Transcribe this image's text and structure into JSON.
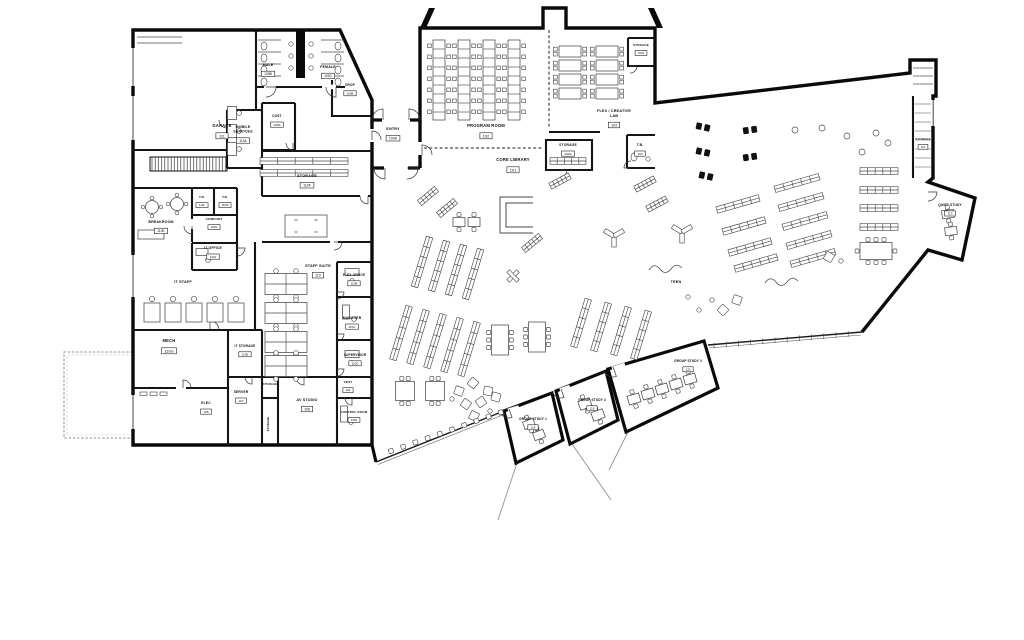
{
  "plan": {
    "type": "architectural-floor-plan",
    "building": "Public Library — Furniture Floor Plan",
    "colors": {
      "wall": "#0a0a0a",
      "interior_wall": "#151515",
      "furniture": "#4a4a4a",
      "glass": "#1a1a1a",
      "site": "#909090",
      "background": "#ffffff",
      "label": "#101010"
    },
    "rooms": [
      {
        "name": "garage",
        "lines": [
          "GARAGE"
        ],
        "number": "111",
        "x": 222,
        "y": 127
      },
      {
        "name": "male",
        "lines": [
          "MALE"
        ],
        "number": "105B",
        "x": 268,
        "y": 66,
        "size": 3.6
      },
      {
        "name": "female",
        "lines": [
          "FEMALE"
        ],
        "number": "105C",
        "x": 328,
        "y": 68,
        "size": 3.6
      },
      {
        "name": "drop",
        "lines": [
          "DROP"
        ],
        "number": "100B",
        "x": 350,
        "y": 86,
        "size": 3.2
      },
      {
        "name": "cust",
        "lines": [
          "CUST"
        ],
        "number": "105A",
        "x": 277,
        "y": 117,
        "size": 3.4
      },
      {
        "name": "mobile-services",
        "lines": [
          "MOBILE",
          "SERVICES"
        ],
        "number": "110A",
        "x": 243,
        "y": 128,
        "size": 3.6
      },
      {
        "name": "entry",
        "lines": [
          "ENTRY"
        ],
        "number": "100A",
        "x": 393,
        "y": 130,
        "size": 3.8
      },
      {
        "name": "storage-110f",
        "lines": [
          "STORAGE"
        ],
        "number": "110F",
        "x": 307,
        "y": 177,
        "size": 3.8
      },
      {
        "name": "program-room",
        "lines": [
          "PROGRAM ROOM"
        ],
        "number": "102",
        "x": 486,
        "y": 127
      },
      {
        "name": "flex-creative-lab",
        "lines": [
          "FLEX / CREATIVE",
          "LAB"
        ],
        "number": "103",
        "x": 614,
        "y": 112,
        "size": 3.8
      },
      {
        "name": "storage-103a",
        "lines": [
          "STORAGE"
        ],
        "number": "103A",
        "x": 641,
        "y": 46,
        "size": 3
      },
      {
        "name": "tb-104",
        "lines": [
          "T.B."
        ],
        "number": "104",
        "x": 640,
        "y": 146,
        "size": 3.4
      },
      {
        "name": "storage-102a",
        "lines": [
          "STORAGE"
        ],
        "number": "102A",
        "x": 568,
        "y": 146,
        "size": 3.4
      },
      {
        "name": "core-library",
        "lines": [
          "CORE LIBRARY"
        ],
        "number": "101",
        "x": 513,
        "y": 161
      },
      {
        "name": "breakroom",
        "lines": [
          "BREAKROOM"
        ],
        "number": "110K",
        "x": 161,
        "y": 223,
        "size": 3.6
      },
      {
        "name": "tb-110l",
        "lines": [
          "T.B."
        ],
        "number": "110L",
        "x": 202,
        "y": 198,
        "size": 3.1
      },
      {
        "name": "tb-110m",
        "lines": [
          "T.B."
        ],
        "number": "110M",
        "x": 225,
        "y": 198,
        "size": 3.1
      },
      {
        "name": "comfort",
        "lines": [
          "COMFORT"
        ],
        "number": "110N",
        "x": 214,
        "y": 220,
        "size": 3.1
      },
      {
        "name": "it-office",
        "lines": [
          "IT OFFICE"
        ],
        "number": "110J",
        "x": 213,
        "y": 249,
        "size": 3.4
      },
      {
        "name": "it-staff",
        "lines": [
          "IT STAFF"
        ],
        "number": "",
        "x": 183,
        "y": 283,
        "size": 3.8
      },
      {
        "name": "staff-suite",
        "lines": [
          "STAFF SUITE"
        ],
        "number": "110",
        "x": 318,
        "y": 267,
        "size": 3.8
      },
      {
        "name": "flex-office",
        "lines": [
          "FLEX OFFICE"
        ],
        "number": "110B",
        "x": 354,
        "y": 276,
        "size": 3.2
      },
      {
        "name": "manager",
        "lines": [
          "MANAGER"
        ],
        "number": "110C",
        "x": 352,
        "y": 319,
        "size": 3.4
      },
      {
        "name": "supervisor",
        "lines": [
          "SUPERVISOR"
        ],
        "number": "110D",
        "x": 355,
        "y": 356,
        "size": 3.2
      },
      {
        "name": "mech",
        "lines": [
          "MECH"
        ],
        "number": "110G",
        "x": 169,
        "y": 342
      },
      {
        "name": "it-storage",
        "lines": [
          "IT STORAGE"
        ],
        "number": "110E",
        "x": 245,
        "y": 347,
        "size": 3.2
      },
      {
        "name": "server",
        "lines": [
          "SERVER"
        ],
        "number": "107",
        "x": 241,
        "y": 393,
        "size": 3.4
      },
      {
        "name": "elec",
        "lines": [
          "ELEC"
        ],
        "number": "106",
        "x": 206,
        "y": 404,
        "size": 3.4
      },
      {
        "name": "storage-107a",
        "lines": [
          "STORAGE"
        ],
        "number": "",
        "x": 270,
        "y": 385,
        "size": 2.8
      },
      {
        "name": "storage-107b",
        "lines": [
          "STORAGE"
        ],
        "number": "",
        "x": 269,
        "y": 424,
        "rot": -90,
        "size": 2.8
      },
      {
        "name": "av-studio",
        "lines": [
          "AV STUDIO"
        ],
        "number": "108",
        "x": 307,
        "y": 401,
        "size": 3.7
      },
      {
        "name": "vest",
        "lines": [
          "VEST"
        ],
        "number": "109",
        "x": 348,
        "y": 383,
        "size": 3.1
      },
      {
        "name": "control-room",
        "lines": [
          "CONTROL ROOM"
        ],
        "number": "108A",
        "x": 354,
        "y": 413,
        "size": 3
      },
      {
        "name": "teen",
        "lines": [
          "TEEN"
        ],
        "number": "",
        "x": 676,
        "y": 283,
        "size": 3.8
      },
      {
        "name": "storage-112",
        "lines": [
          "STORAGE"
        ],
        "number": "112",
        "x": 923,
        "y": 140,
        "size": 2.9
      },
      {
        "name": "quiet-study",
        "lines": [
          "QUIET STUDY"
        ],
        "number": "113",
        "x": 950,
        "y": 206,
        "size": 3.3
      },
      {
        "name": "group-study-1",
        "lines": [
          "GROUP STUDY 1"
        ],
        "number": "118",
        "x": 533,
        "y": 420,
        "size": 3.2
      },
      {
        "name": "group-study-2",
        "lines": [
          "GROUP STUDY 2"
        ],
        "number": "119",
        "x": 592,
        "y": 401,
        "size": 3.2
      },
      {
        "name": "group-study-3",
        "lines": [
          "GROUP STUDY 3"
        ],
        "number": "120",
        "x": 688,
        "y": 362,
        "size": 3.2
      }
    ]
  }
}
